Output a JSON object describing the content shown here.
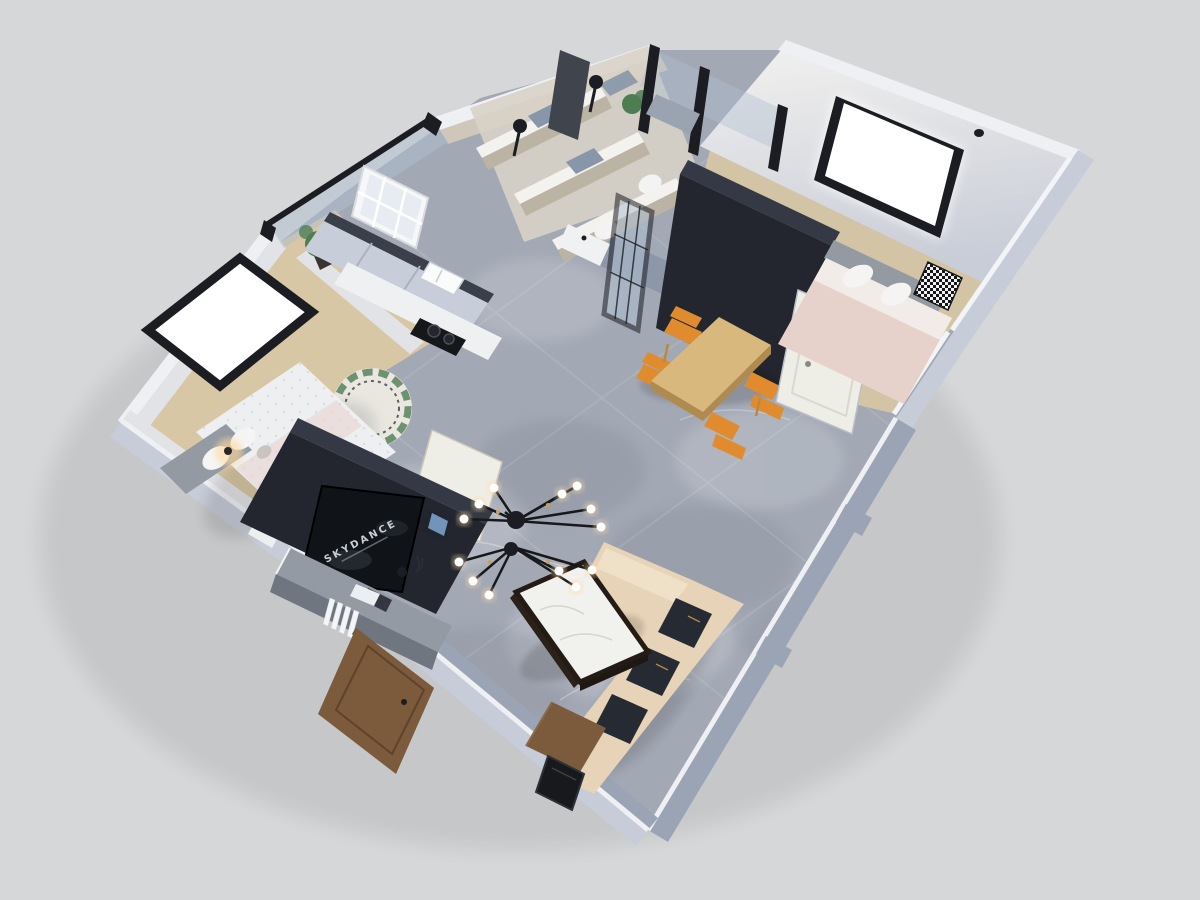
{
  "palette": {
    "bg": "#d6d7d9",
    "floor": "#a2a8b4",
    "floor_dark": "#878d9a",
    "wall_top": "#eef0f4",
    "wall_light": "#c6ccd8",
    "wall_med": "#9ba4b4",
    "wall_inner": "#e2e3e6",
    "gray_wall": "#8d97aa",
    "beige_wall": "#cfc8ba",
    "beige_dark": "#bbb3a4",
    "beige_floor": "#d8d2c6",
    "slab": "#23262e",
    "slab_top": "#343945",
    "screen": "#101318",
    "console": "#939aa4",
    "console_front": "#6f7680",
    "wood": "#d9b87e",
    "wood_dark": "#b08b4f",
    "wood_floor": "#d8c7a4",
    "orange": "#e08b2d",
    "sofa": "#e7d3b7",
    "sofa_light": "#efe0c8",
    "cushion": "#262a33",
    "white": "#edeff1",
    "pink": "#e7d2cb",
    "headboard": "#939aa2",
    "mat": "#8796a8",
    "glass": "#aebfd0",
    "frame": "#1b1d22",
    "marble": "#f1f1ee",
    "green": "#4e7d52",
    "warm": "#ffd9a0",
    "brass": "#c9a24a",
    "cream": "#efeee6",
    "door_brown": "#7c5a3c",
    "door_brown_dark": "#5e432b",
    "cabinet": "#c7ceda"
  },
  "scene": {
    "view": "3d-dollhouse-floor-plan",
    "living_room": {
      "tv_text": "SKYDANCE",
      "items": [
        "tv-feature-wall",
        "tv-screen",
        "media-console",
        "books",
        "sputnik-chandelier",
        "marble-coffee-table",
        "l-shaped-sofa",
        "dark-cushions",
        "wood-side-table",
        "leaning-frame",
        "entry-door"
      ]
    },
    "dining_area": {
      "items": [
        "wood-dining-table",
        "orange-chair",
        "orange-chair",
        "orange-chair",
        "orange-chair",
        "hall-wardrobe",
        "bedroom-door"
      ]
    },
    "kitchen": {
      "items": [
        "cabinet-run",
        "countertop",
        "sink",
        "cooktop",
        "grid-window"
      ]
    },
    "balcony": {
      "items": [
        "glass-railing",
        "potted-plant"
      ]
    },
    "bathroom": {
      "items": [
        "shower-head",
        "shower-head",
        "shower-mats",
        "toilet",
        "toilet",
        "glass-grid-door",
        "washbasin",
        "plant",
        "tall-cabinet"
      ]
    },
    "bedroom_left": {
      "items": [
        "double-bed",
        "tufted-duvet",
        "pillows",
        "bedside-lamp",
        "round-rug",
        "wardrobe-tv-wall",
        "floating-window"
      ]
    },
    "bedroom_right": {
      "items": [
        "double-bed",
        "pink-bedding",
        "checkered-pillow",
        "dark-wardrobe",
        "picture-window",
        "pendant-light",
        "white-door"
      ]
    }
  }
}
